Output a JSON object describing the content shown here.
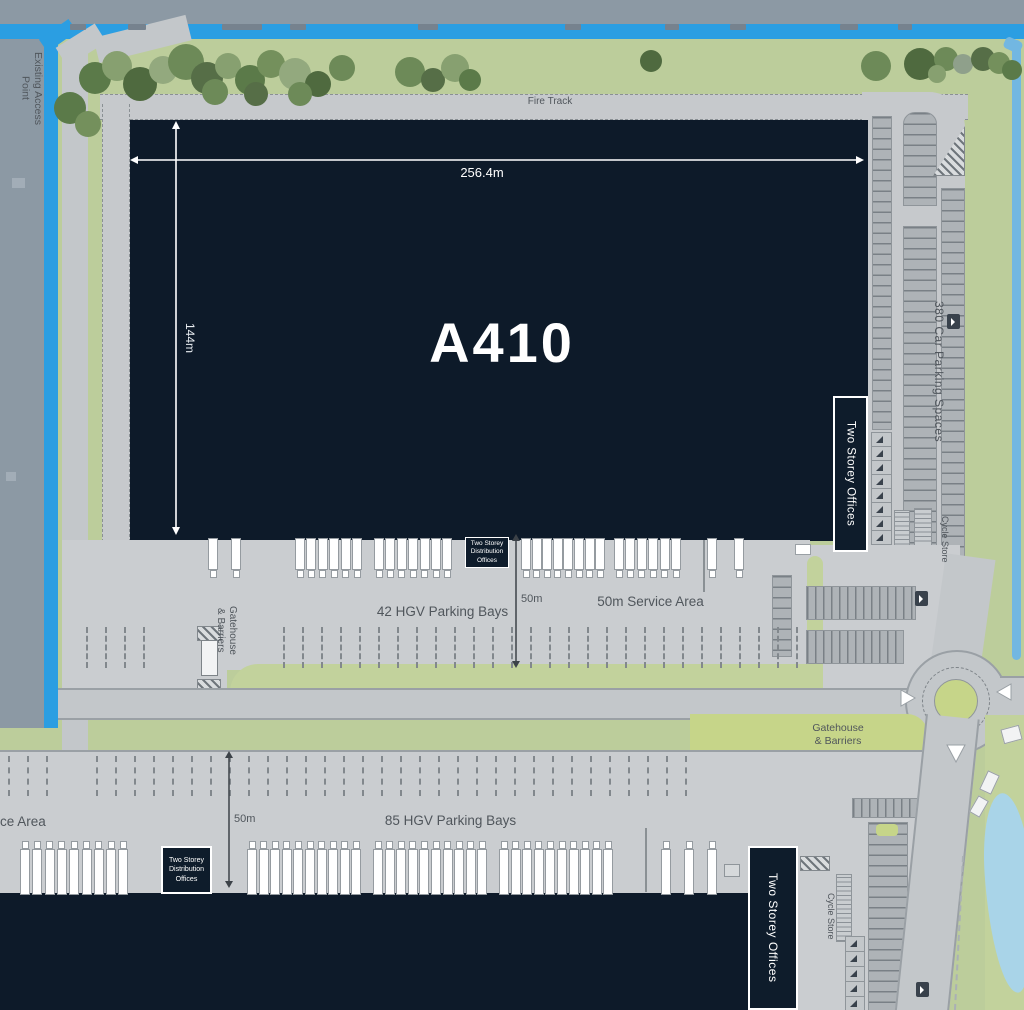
{
  "site": {
    "access": {
      "existing_access_point": "Existing Access\nPoint"
    },
    "fire_track": "Fire Track",
    "building": {
      "name": "A410",
      "width": "256.4m",
      "depth": "144m",
      "offices": "Two Storey Offices"
    },
    "parking_east": {
      "car_spaces": "380 Car Parking Spaces",
      "cycle_store": "Cycle Store"
    },
    "yard_upper": {
      "distribution_offices": "Two Storey\nDistribution\nOffices",
      "bays": "42 HGV Parking Bays",
      "depth": "50m",
      "service_area": "50m Service Area",
      "gatehouse": "Gatehouse\n& Barriers"
    },
    "yard_lower": {
      "service_area_partial": "ce Area",
      "depth": "50m",
      "bays": "85 HGV Parking Bays",
      "distribution_offices": "Two Storey\nDistribution\nOffices",
      "offices": "Two Storey Offices",
      "gatehouse": "Gatehouse\n& Barriers",
      "cycle_store": "Cycle Store"
    }
  },
  "colors": {
    "slate_offsite": "#8c99a4",
    "road_blue": "#2b9ee2",
    "stream_blue": "#72b7e2",
    "pond_blue": "#a9d4e8",
    "landscape_green": "#bccd9b",
    "verge_green": "#c6d589",
    "hardstanding": "#cacdd0",
    "road_gray": "#c3c7ca",
    "kerb_gray": "#9aa0a5",
    "building_navy": "#0d1a29",
    "label_gray": "#50565c",
    "dimension_white": "#ffffff",
    "dimension_dark": "#3c4248",
    "tree_palette": [
      "#4f6a3f",
      "#5b7a49",
      "#6d8a58",
      "#74905c",
      "#87a070",
      "#93a97e",
      "#8fa08b",
      "#566e47"
    ]
  },
  "graphics": {
    "trees": [
      [
        70,
        108,
        16,
        1
      ],
      [
        88,
        124,
        13,
        3
      ],
      [
        95,
        78,
        16,
        1
      ],
      [
        117,
        66,
        15,
        4
      ],
      [
        140,
        84,
        17,
        0
      ],
      [
        163,
        70,
        14,
        5
      ],
      [
        186,
        62,
        18,
        2
      ],
      [
        207,
        78,
        16,
        7
      ],
      [
        228,
        66,
        13,
        4
      ],
      [
        250,
        80,
        15,
        1
      ],
      [
        271,
        64,
        14,
        3
      ],
      [
        295,
        74,
        16,
        5
      ],
      [
        318,
        84,
        13,
        0
      ],
      [
        342,
        68,
        13,
        2
      ],
      [
        300,
        94,
        12,
        2
      ],
      [
        256,
        94,
        12,
        7
      ],
      [
        215,
        92,
        13,
        2
      ],
      [
        410,
        72,
        15,
        2
      ],
      [
        433,
        80,
        12,
        7
      ],
      [
        455,
        68,
        14,
        4
      ],
      [
        470,
        80,
        11,
        1
      ],
      [
        651,
        61,
        11,
        0
      ],
      [
        876,
        66,
        15,
        2
      ],
      [
        920,
        64,
        16,
        0
      ],
      [
        946,
        59,
        12,
        2
      ],
      [
        963,
        64,
        10,
        6
      ],
      [
        983,
        59,
        12,
        7
      ],
      [
        999,
        63,
        11,
        3
      ],
      [
        1012,
        70,
        10,
        1
      ],
      [
        937,
        74,
        9,
        4
      ]
    ],
    "top_vehicles": [
      [
        70,
        16
      ],
      [
        128,
        18
      ],
      [
        222,
        40
      ],
      [
        290,
        16
      ],
      [
        418,
        20
      ],
      [
        565,
        16
      ],
      [
        665,
        14
      ],
      [
        730,
        16
      ],
      [
        840,
        18
      ],
      [
        898,
        14
      ]
    ],
    "truck_rows": [
      {
        "y": 538,
        "h": 30,
        "dir": "down",
        "groups": [
          {
            "x": 208,
            "n": 1,
            "sp": 12
          },
          {
            "x": 231,
            "n": 1,
            "sp": 12
          },
          {
            "x": 295,
            "n": 6,
            "sp": 11.4
          },
          {
            "x": 374,
            "n": 7,
            "sp": 11.4
          },
          {
            "x": 521,
            "n": 8,
            "sp": 10.6
          },
          {
            "x": 614,
            "n": 6,
            "sp": 11.4
          },
          {
            "x": 707,
            "n": 1,
            "sp": 12
          },
          {
            "x": 734,
            "n": 1,
            "sp": 12
          }
        ]
      },
      {
        "y": 849,
        "h": 44,
        "dir": "up",
        "groups": [
          {
            "x": 20,
            "n": 9,
            "sp": 12.3
          },
          {
            "x": 247,
            "n": 10,
            "sp": 11.6
          },
          {
            "x": 373,
            "n": 10,
            "sp": 11.6
          },
          {
            "x": 499,
            "n": 10,
            "sp": 11.6
          },
          {
            "x": 661,
            "n": 3,
            "sp": 23
          }
        ]
      }
    ],
    "dash_rows": [
      {
        "x0": 283,
        "x1": 798,
        "y": 627,
        "h": 41,
        "sp": 19
      },
      {
        "x0": 86,
        "x1": 148,
        "y": 627,
        "h": 41,
        "sp": 19
      },
      {
        "x0": 8,
        "x1": 52,
        "y": 756,
        "h": 40,
        "sp": 19
      },
      {
        "x0": 96,
        "x1": 698,
        "y": 756,
        "h": 40,
        "sp": 19
      }
    ],
    "arrow_cell_cols": [
      {
        "x": 871,
        "y": 432,
        "n": 8,
        "w": 19,
        "h": 14
      },
      {
        "x": 845,
        "y": 936,
        "n": 5,
        "w": 18,
        "h": 15
      }
    ],
    "mark_icons": [
      [
        947,
        314
      ],
      [
        915,
        591
      ],
      [
        916,
        982
      ]
    ]
  }
}
